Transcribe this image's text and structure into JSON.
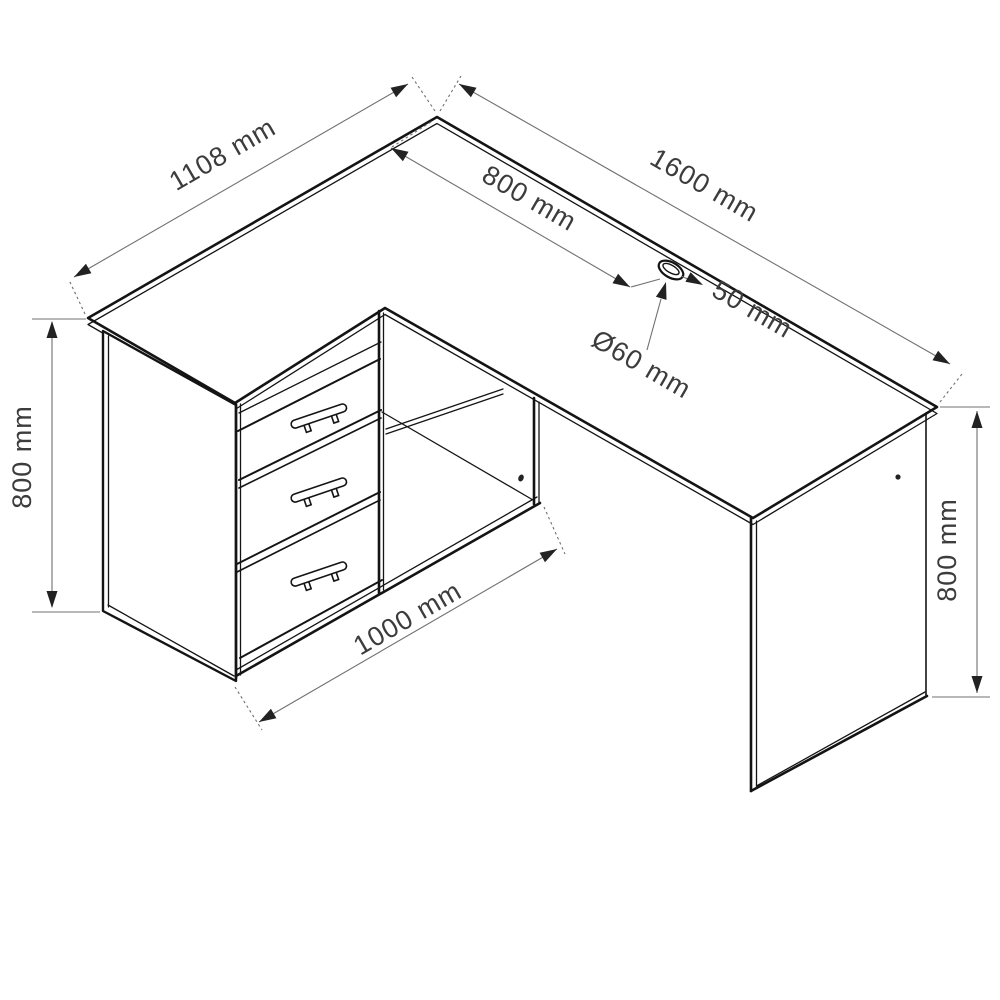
{
  "drawing": {
    "title": "L-shaped corner desk with three drawers and open shelf - dimension diagram",
    "dimensions": {
      "left_depth": {
        "label": "1108 mm"
      },
      "top_width": {
        "label": "1600 mm"
      },
      "grommet_from_left": {
        "label": "800 mm"
      },
      "grommet_from_edge": {
        "label": "50 mm"
      },
      "grommet_diameter": {
        "label": "Ø60 mm"
      },
      "left_height": {
        "label": "800 mm"
      },
      "unit_width": {
        "label": "1000 mm"
      },
      "right_height": {
        "label": "800 mm"
      }
    },
    "features": {
      "drawer_count": 3,
      "grommet": "cable-grommet-hole"
    }
  },
  "colors": {
    "line": "#141414",
    "dim_line": "#707070",
    "text": "#3c3c3c",
    "background": "#ffffff"
  }
}
